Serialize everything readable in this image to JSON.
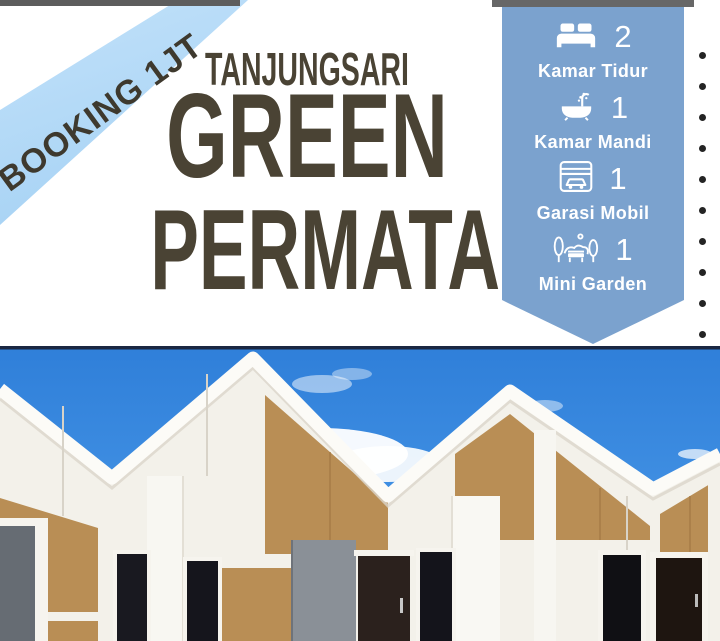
{
  "ribbon": {
    "label": "BOOKING 1JT"
  },
  "title": {
    "line1": "TANJUNGSARI",
    "line2": "GREEN",
    "line3": "PERMATA"
  },
  "features": {
    "items": [
      {
        "icon": "bed-icon",
        "count": "2",
        "label": "Kamar Tidur"
      },
      {
        "icon": "bathtub-icon",
        "count": "1",
        "label": "Kamar Mandi"
      },
      {
        "icon": "garage-icon",
        "count": "1",
        "label": "Garasi Mobil"
      },
      {
        "icon": "garden-icon",
        "count": "1",
        "label": "Mini Garden"
      }
    ]
  },
  "decor": {
    "dot_count": 10
  },
  "colors": {
    "ribbon_blue": "#aed6f5",
    "panel_blue": "#7ba2ce",
    "title_brown": "#4a4334",
    "accent_tan": "#b98e55",
    "sky_blue": "#3d8de2",
    "top_bar_gray": "#5d5d5d",
    "dot_black": "#242424"
  }
}
